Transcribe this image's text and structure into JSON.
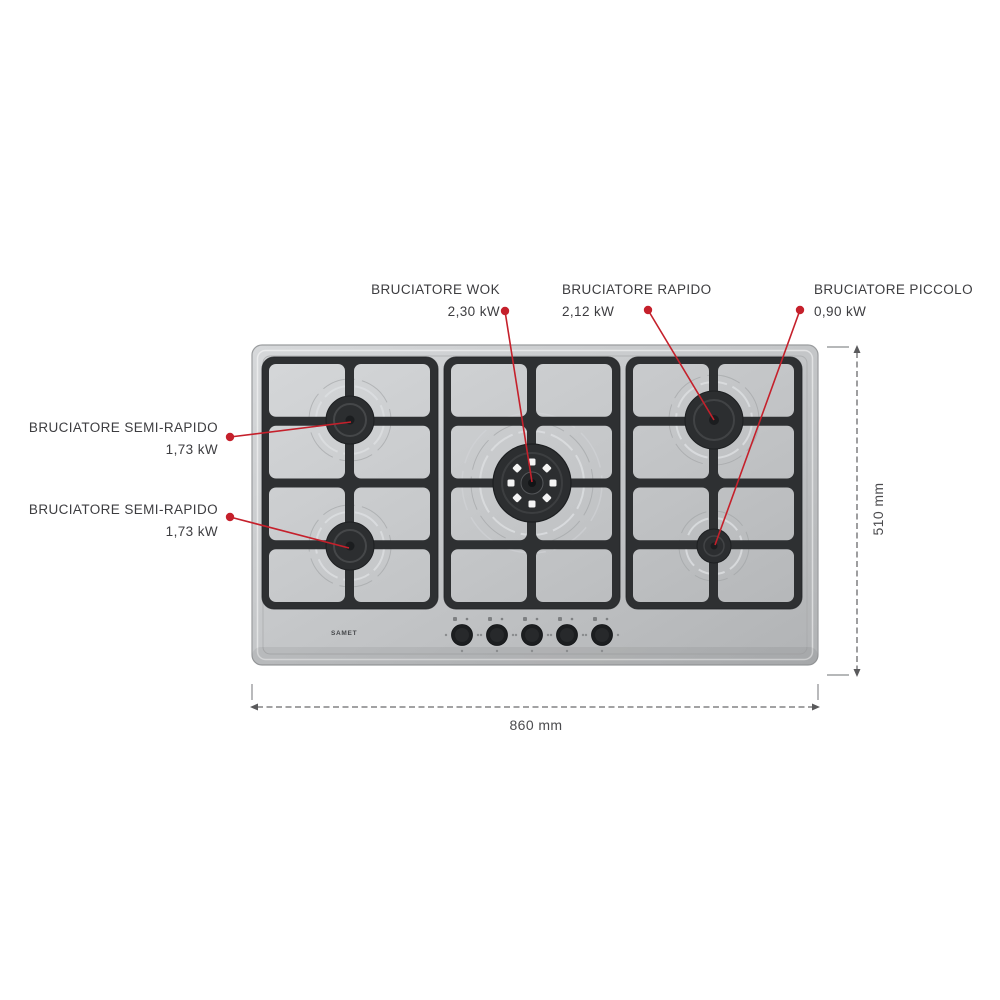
{
  "annotations": [
    {
      "id": "semi-rapido-top-left",
      "name": "BRUCIATORE SEMI-RAPIDO",
      "power": "1,73 kW"
    },
    {
      "id": "semi-rapido-bottom-left",
      "name": "BRUCIATORE SEMI-RAPIDO",
      "power": "1,73 kW"
    },
    {
      "id": "wok",
      "name": "BRUCIATORE WOK",
      "power": "2,30 kW"
    },
    {
      "id": "rapido",
      "name": "BRUCIATORE RAPIDO",
      "power": "2,12 kW"
    },
    {
      "id": "piccolo",
      "name": "BRUCIATORE PICCOLO",
      "power": "0,90 kW"
    }
  ],
  "dimensions": {
    "width_label": "860 mm",
    "height_label": "510 mm"
  },
  "brand": "SAMET",
  "colors": {
    "accent_red": "#c5202b",
    "label_text": "#3d3d40",
    "dimension_text": "#4b4b4e",
    "hob_surface": "#c4c6c8",
    "grate": "#2e3032",
    "burner": "#2c2e30"
  }
}
